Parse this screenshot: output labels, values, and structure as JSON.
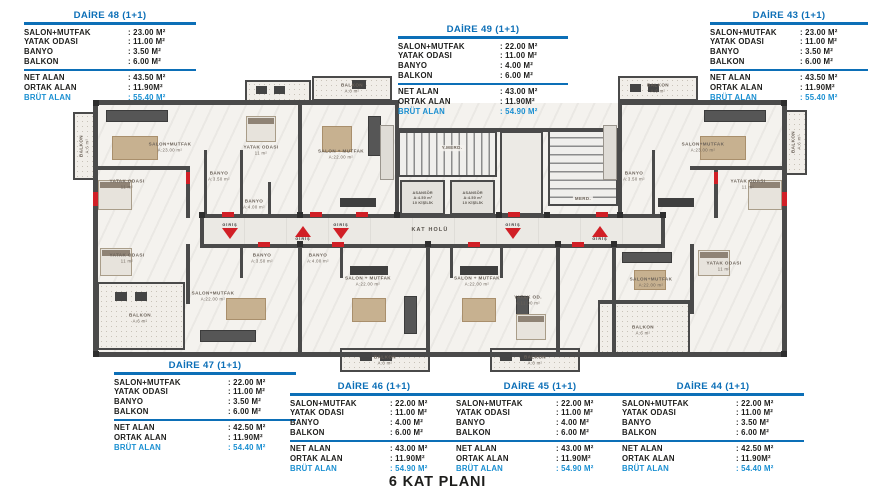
{
  "page": {
    "title": "6 KAT PLANI"
  },
  "colors": {
    "accent_blue": "#0c6fb7",
    "brut_blue": "#1a8fd1",
    "wall_gray": "#4a4a4a",
    "door_red": "#d11f26"
  },
  "apartments": [
    {
      "id": "daire-48",
      "title": "DAİRE 48",
      "type": "(1+1)",
      "specs": [
        {
          "label": "SALON+MUTFAK",
          "value": ": 23.00 M²"
        },
        {
          "label": "YATAK ODASI",
          "value": ": 11.00 M²"
        },
        {
          "label": "BANYO",
          "value": ": 3.50 M²"
        },
        {
          "label": "BALKON",
          "value": ": 6.00 M²"
        }
      ],
      "totals": [
        {
          "label": "NET ALAN",
          "value": ": 43.50 M²"
        },
        {
          "label": "ORTAK ALAN",
          "value": ": 11.90M²"
        }
      ],
      "brut": {
        "label": "BRÜT ALAN",
        "value": ": 55.40 M²"
      }
    },
    {
      "id": "daire-49",
      "title": "DAİRE 49",
      "type": "(1+1)",
      "specs": [
        {
          "label": "SALON+MUTFAK",
          "value": ": 22.00 M²"
        },
        {
          "label": "YATAK ODASI",
          "value": ": 11.00 M²"
        },
        {
          "label": "BANYO",
          "value": ": 4.00 M²"
        },
        {
          "label": "BALKON",
          "value": ": 6.00 M²"
        }
      ],
      "totals": [
        {
          "label": "NET ALAN",
          "value": ": 43.00 M²"
        },
        {
          "label": "ORTAK ALAN",
          "value": ": 11.90M²"
        }
      ],
      "brut": {
        "label": "BRÜT ALAN",
        "value": ": 54.90 M²"
      }
    },
    {
      "id": "daire-43",
      "title": "DAİRE 43",
      "type": "(1+1)",
      "specs": [
        {
          "label": "SALON+MUTFAK",
          "value": ": 23.00 M²"
        },
        {
          "label": "YATAK ODASI",
          "value": ": 11.00 M²"
        },
        {
          "label": "BANYO",
          "value": ": 3.50 M²"
        },
        {
          "label": "BALKON",
          "value": ": 6.00 M²"
        }
      ],
      "totals": [
        {
          "label": "NET ALAN",
          "value": ": 43.50 M²"
        },
        {
          "label": "ORTAK ALAN",
          "value": ": 11.90M²"
        }
      ],
      "brut": {
        "label": "BRÜT ALAN",
        "value": ": 55.40 M²"
      }
    },
    {
      "id": "daire-47",
      "title": "DAİRE 47",
      "type": "(1+1)",
      "specs": [
        {
          "label": "SALON+MUTFAK",
          "value": ": 22.00 M²"
        },
        {
          "label": "YATAK ODASI",
          "value": ": 11.00 M²"
        },
        {
          "label": "BANYO",
          "value": ": 3.50 M²"
        },
        {
          "label": "BALKON",
          "value": ": 6.00 M²"
        }
      ],
      "totals": [
        {
          "label": "NET ALAN",
          "value": ": 42.50 M²"
        },
        {
          "label": "ORTAK ALAN",
          "value": ": 11.90M²"
        }
      ],
      "brut": {
        "label": "BRÜT ALAN",
        "value": ": 54.40 M²"
      }
    },
    {
      "id": "daire-46",
      "title": "DAİRE 46",
      "type": "(1+1)",
      "specs": [
        {
          "label": "SALON+MUTFAK",
          "value": ": 22.00 M²"
        },
        {
          "label": "YATAK ODASI",
          "value": ": 11.00 M²"
        },
        {
          "label": "BANYO",
          "value": ": 4.00 M²"
        },
        {
          "label": "BALKON",
          "value": ": 6.00 M²"
        }
      ],
      "totals": [
        {
          "label": "NET ALAN",
          "value": ": 43.00 M²"
        },
        {
          "label": "ORTAK ALAN",
          "value": ": 11.90M²"
        }
      ],
      "brut": {
        "label": "BRÜT ALAN",
        "value": ": 54.90 M²"
      }
    },
    {
      "id": "daire-45",
      "title": "DAİRE 45",
      "type": "(1+1)",
      "specs": [
        {
          "label": "SALON+MUTFAK",
          "value": ": 22.00 M²"
        },
        {
          "label": "YATAK ODASI",
          "value": ": 11.00 M²"
        },
        {
          "label": "BANYO",
          "value": ": 4.00 M²"
        },
        {
          "label": "BALKON",
          "value": ": 6.00 M²"
        }
      ],
      "totals": [
        {
          "label": "NET ALAN",
          "value": ": 43.00 M²"
        },
        {
          "label": "ORTAK ALAN",
          "value": ": 11.90M²"
        }
      ],
      "brut": {
        "label": "BRÜT ALAN",
        "value": ": 54.90 M²"
      }
    },
    {
      "id": "daire-44",
      "title": "DAİRE 44",
      "type": "(1+1)",
      "specs": [
        {
          "label": "SALON+MUTFAK",
          "value": ": 22.00 M²"
        },
        {
          "label": "YATAK ODASI",
          "value": ": 11.00 M²"
        },
        {
          "label": "BANYO",
          "value": ": 3.50 M²"
        },
        {
          "label": "BALKON",
          "value": ": 6.00 M²"
        }
      ],
      "totals": [
        {
          "label": "NET ALAN",
          "value": ": 42.50 M²"
        },
        {
          "label": "ORTAK ALAN",
          "value": ": 11.90M²"
        }
      ],
      "brut": {
        "label": "BRÜT ALAN",
        "value": ": 54.40 M²"
      }
    }
  ],
  "plan": {
    "elevator": {
      "name": "ASANSÖR",
      "area": "A:4.50 m²",
      "capacity": "10 KİŞİLİK"
    },
    "entrance_label": "GİRİŞ",
    "labels": [
      {
        "text": "SALON+MUTFAK",
        "sub": "A:23.00 m²",
        "x": 170,
        "y": 147
      },
      {
        "text": "YATAK ODASI",
        "sub": "11 m²",
        "x": 127,
        "y": 184
      },
      {
        "text": "BANYO",
        "sub": "A:3.50 m²",
        "x": 219,
        "y": 176
      },
      {
        "text": "YATAK ODASI",
        "sub": "11 m²",
        "x": 261,
        "y": 150
      },
      {
        "text": "BANYO",
        "sub": "A:4.00 m²",
        "x": 254,
        "y": 204
      },
      {
        "text": "SALON + MUTFAK",
        "sub": "A:22.00 m²",
        "x": 341,
        "y": 154
      },
      {
        "text": "BALKON",
        "sub": "A:6 m²",
        "x": 352,
        "y": 88
      },
      {
        "text": "BALKON",
        "sub": "A:6 m²",
        "x": 658,
        "y": 88
      },
      {
        "text": "SALON+MUTFAK",
        "sub": "A:23.00 m²",
        "x": 703,
        "y": 147
      },
      {
        "text": "YATAK ODASI",
        "sub": "11 m²",
        "x": 748,
        "y": 184
      },
      {
        "text": "BANYO",
        "sub": "A:3.50 m²",
        "x": 634,
        "y": 176
      },
      {
        "text": "BALKON",
        "sub": "A:6 m²",
        "x": 84,
        "y": 146,
        "cls": "rv"
      },
      {
        "text": "BALKON",
        "sub": "A:6 m²",
        "x": 796,
        "y": 142,
        "cls": "rv"
      },
      {
        "text": "KAT HOLÜ",
        "sub": "",
        "x": 430,
        "y": 231,
        "cls": "hallname"
      },
      {
        "text": "Y.MERD.",
        "sub": "",
        "x": 452,
        "y": 148,
        "cls": "tiny"
      },
      {
        "text": "MERD.",
        "sub": "",
        "x": 583,
        "y": 199,
        "cls": "tiny"
      },
      {
        "text": "SALON+MUTFAK",
        "sub": "A:22.00 m²",
        "x": 213,
        "y": 296
      },
      {
        "text": "BALKON",
        "sub": "A:6 m²",
        "x": 140,
        "y": 318
      },
      {
        "text": "YATAK ODASI",
        "sub": "11 m²",
        "x": 127,
        "y": 258
      },
      {
        "text": "BANYO",
        "sub": "A:3.50 m²",
        "x": 262,
        "y": 258
      },
      {
        "text": "BANYO",
        "sub": "A:4.00 m²",
        "x": 318,
        "y": 258
      },
      {
        "text": "SALON + MUTFAK",
        "sub": "A:22.00 m²",
        "x": 368,
        "y": 281
      },
      {
        "text": "SALON + MUTFAK",
        "sub": "A:22.00 m²",
        "x": 477,
        "y": 281
      },
      {
        "text": "YATAK OD.",
        "sub": "A:11.00 m²",
        "x": 528,
        "y": 300
      },
      {
        "text": "SALON+MUTFAK",
        "sub": "A:22.00 m²",
        "x": 651,
        "y": 282
      },
      {
        "text": "YATAK ODASI",
        "sub": "11 m²",
        "x": 724,
        "y": 266
      },
      {
        "text": "BALKON",
        "sub": "A:6 m²",
        "x": 643,
        "y": 330
      },
      {
        "text": "BALKON",
        "sub": "A:6 m²",
        "x": 385,
        "y": 360
      },
      {
        "text": "BALKON",
        "sub": "A:6 m²",
        "x": 535,
        "y": 360
      }
    ],
    "entrances": [
      {
        "x": 230,
        "y": 223,
        "dir": "down"
      },
      {
        "x": 303,
        "y": 226,
        "dir": "up"
      },
      {
        "x": 341,
        "y": 223,
        "dir": "down"
      },
      {
        "x": 513,
        "y": 223,
        "dir": "down"
      },
      {
        "x": 600,
        "y": 226,
        "dir": "up"
      }
    ]
  }
}
